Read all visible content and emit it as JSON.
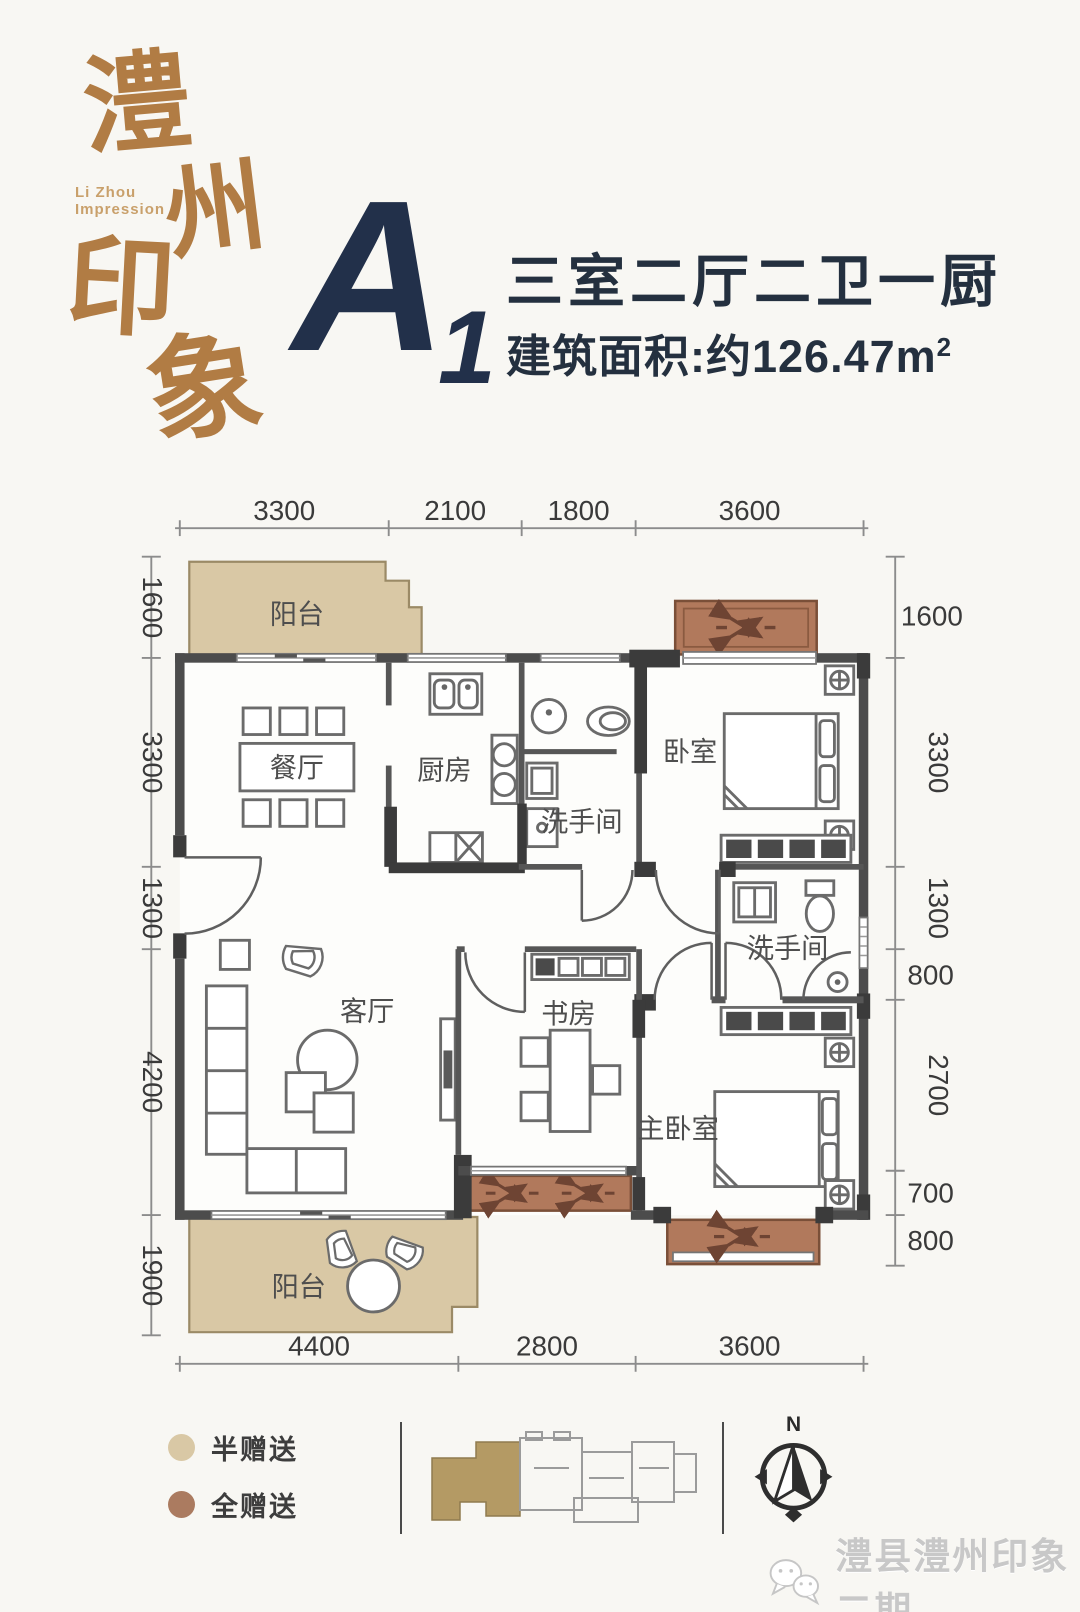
{
  "brand": {
    "logo_chars": [
      "澧",
      "州",
      "印",
      "象"
    ],
    "logo_sub_line1": "Li Zhou",
    "logo_sub_line2": "Impression",
    "color": "#b17c44"
  },
  "header": {
    "unit_letter": "A",
    "unit_number": "1",
    "title": "三室二厅二卫一厨",
    "area_text": "建筑面积:约126.47m",
    "area_sup": "2",
    "text_color": "#24303f"
  },
  "plan": {
    "labels": {
      "balcony_top": "阳台",
      "dining": "餐厅",
      "kitchen": "厨房",
      "bath1": "洗手间",
      "bedroom": "卧室",
      "bath2": "洗手间",
      "master": "主卧室",
      "study": "书房",
      "living": "客厅",
      "balcony_bottom": "阳台"
    },
    "dims_top": [
      "3300",
      "2100",
      "1800",
      "3600"
    ],
    "dims_bottom": [
      "4400",
      "2800",
      "3600"
    ],
    "dims_left": [
      "1600",
      "3300",
      "1300",
      "4200",
      "1900"
    ],
    "dims_right": [
      "1600",
      "3300",
      "1300",
      "800",
      "2700",
      "700",
      "800"
    ],
    "colors": {
      "half_gift": "#d9c8a5",
      "full_gift": "#b1795c",
      "wall": "#4c4c4c"
    }
  },
  "legend": {
    "items": [
      {
        "label": "半赠送",
        "color": "#d9c8a5"
      },
      {
        "label": "全赠送",
        "color": "#ab7b60"
      }
    ]
  },
  "keyplan": {
    "highlight_color": "#b49a64"
  },
  "compass": {
    "north_label": "N"
  },
  "footer": {
    "watermark": "澧县澧州印象二期"
  }
}
